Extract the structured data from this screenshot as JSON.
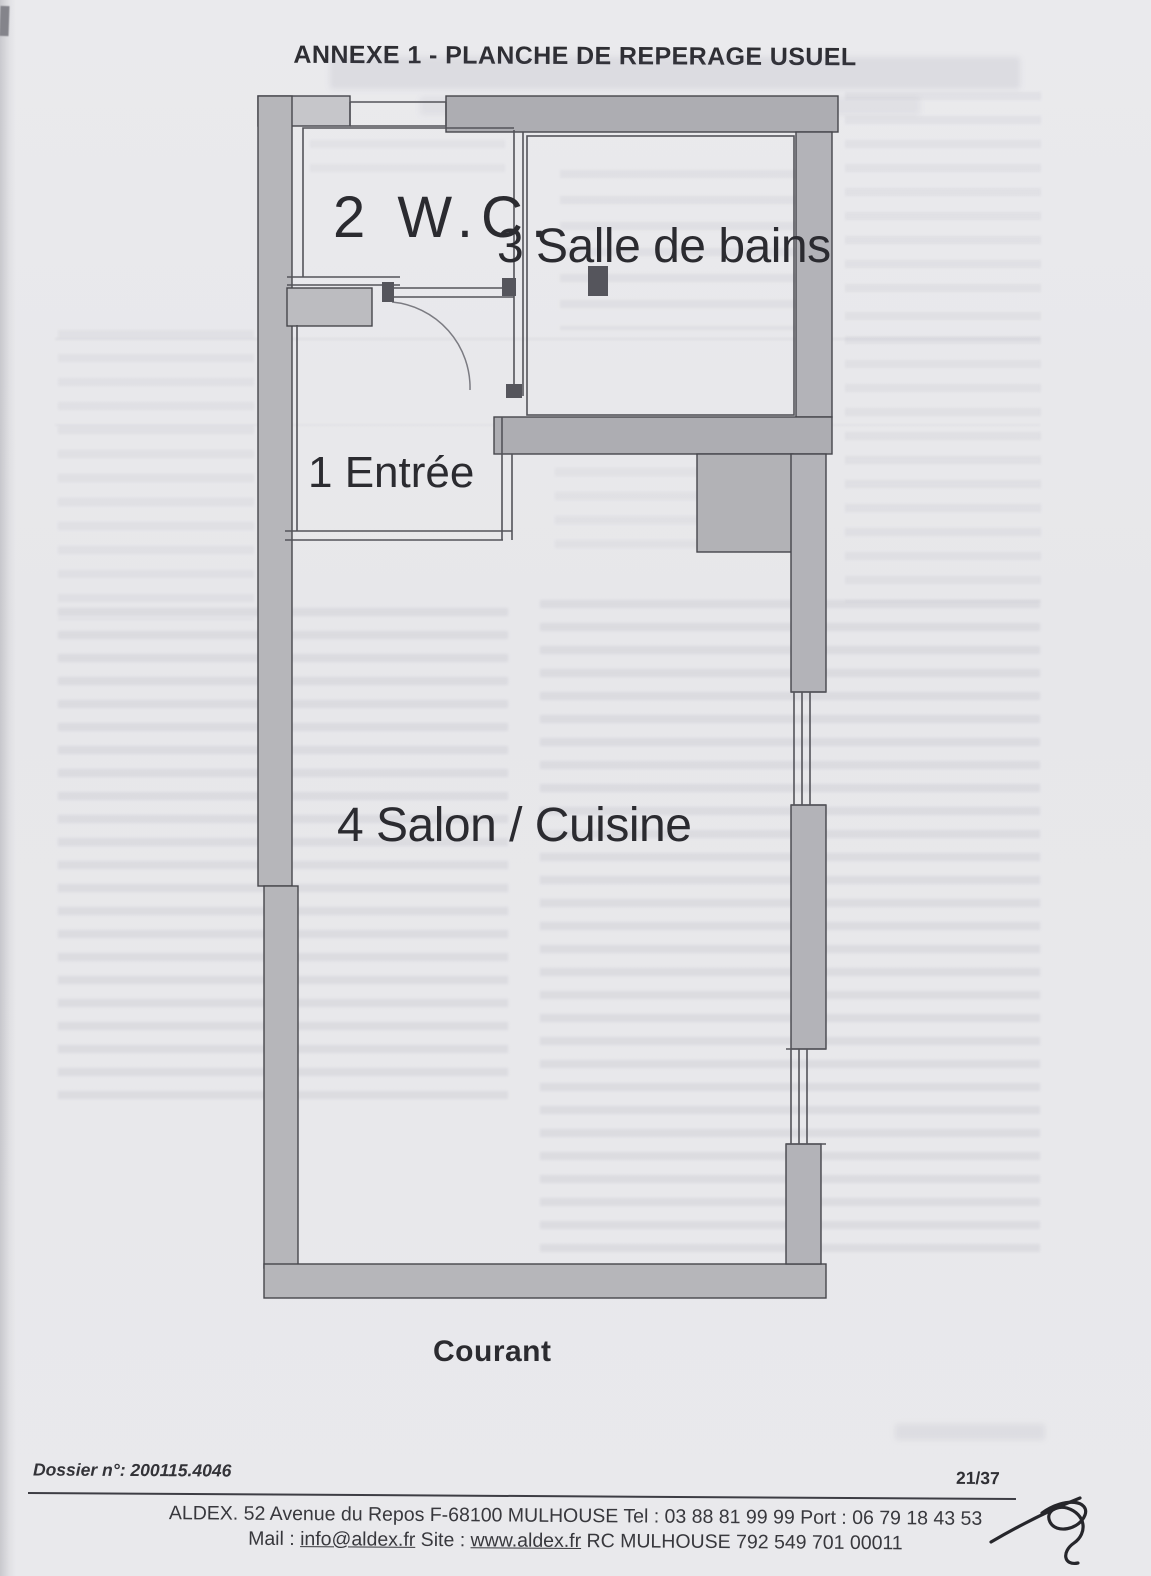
{
  "page": {
    "title": "ANNEXE 1 - PLANCHE DE REPERAGE USUEL",
    "dossier": "Dossier n°: 200115.4046",
    "page_number": "21/37",
    "footer": {
      "line1": "ALDEX. 52 Avenue du Repos F-68100 MULHOUSE Tel : 03 88 81 99 99 Port : 06 79 18 43 53",
      "mail_label": "Mail : ",
      "mail_link": "info@aldex.fr",
      "site_label": " Site : ",
      "site_link": "www.aldex.fr",
      "rc": " RC MULHOUSE 792 549 701 00011"
    }
  },
  "floor_plan": {
    "caption": "Courant",
    "rooms": [
      {
        "id": "entree",
        "label": "1 Entrée"
      },
      {
        "id": "wc",
        "label": "2 W.C."
      },
      {
        "id": "salle_de_bains",
        "label": "3 Salle de bains"
      },
      {
        "id": "salon_cuisine",
        "label": "4 Salon / Cuisine"
      }
    ]
  },
  "colors": {
    "page_bg": "#e9e9ec",
    "wall_fill": "#b6b6ba",
    "wall_fill_dark": "#adadb2",
    "wall_fill_light": "#c6c6ca",
    "wall_stroke": "#46464c",
    "thin_line": "#54545a",
    "text": "#2b2b30"
  }
}
